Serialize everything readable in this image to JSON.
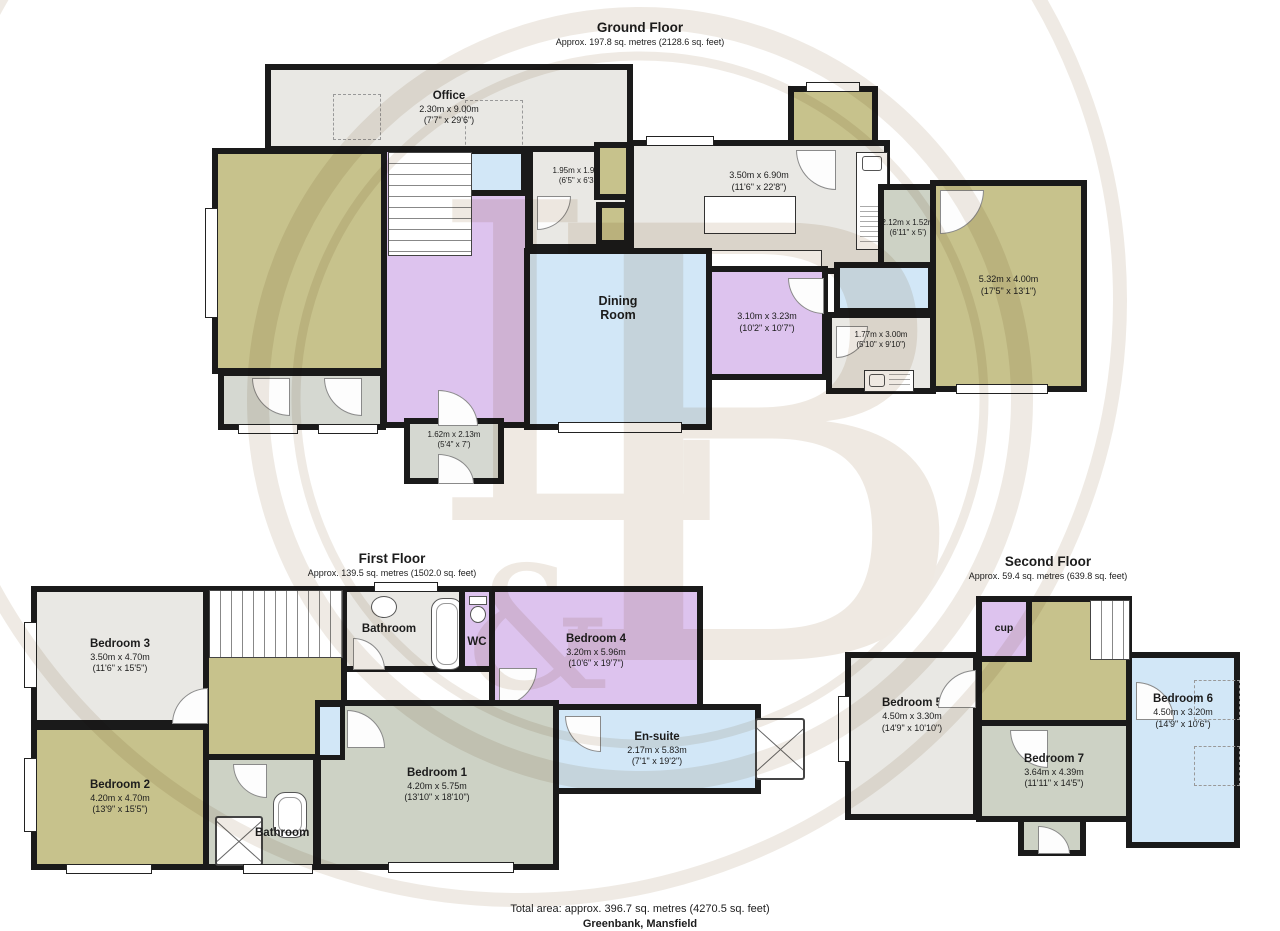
{
  "palette": {
    "wall": "#1a1a1a",
    "olive": "#c7c28c",
    "light_gray_room": "#e9e8e4",
    "green_gray_room": "#cdd2c5",
    "lavender_room": "#ddc3ee",
    "blue_room": "#d2e7f7",
    "conservatory_gray": "#d5d8d1",
    "watermark": "#e9e3da"
  },
  "floors": {
    "ground": {
      "title": "Ground Floor",
      "subtitle": "Approx. 197.8 sq. metres (2128.6 sq. feet)",
      "rooms": {
        "office": {
          "name": "Office",
          "dims_m": "2.30m x 9.00m",
          "dims_ft": "(7'7\" x 29'6\")"
        },
        "hall_small": {
          "dims_m": "1.95m x 1.91m",
          "dims_ft": "(6'5\" x 6'3\")"
        },
        "kitchen": {
          "dims_m": "3.50m x 6.90m",
          "dims_ft": "(11'6\" x 22'8\")"
        },
        "pantry": {
          "dims_m": "2.12m x 1.52m",
          "dims_ft": "(6'11\" x 5')"
        },
        "garage": {
          "dims_m": "5.32m x 4.00m",
          "dims_ft": "(17'5\" x 13'1\")"
        },
        "dining": {
          "name": "Dining Room"
        },
        "family": {
          "dims_m": "3.10m x 3.23m",
          "dims_ft": "(10'2\" x 10'7\")"
        },
        "utility": {
          "dims_m": "1.77m x 3.00m",
          "dims_ft": "(5'10\" x 9'10\")"
        },
        "porch": {
          "dims_m": "1.62m x 2.13m",
          "dims_ft": "(5'4\" x 7')"
        }
      }
    },
    "first": {
      "title": "First Floor",
      "subtitle": "Approx. 139.5 sq. metres (1502.0 sq. feet)",
      "rooms": {
        "bedroom3": {
          "name": "Bedroom 3",
          "dims_m": "3.50m x 4.70m",
          "dims_ft": "(11'6\" x 15'5\")"
        },
        "bedroom2": {
          "name": "Bedroom 2",
          "dims_m": "4.20m x 4.70m",
          "dims_ft": "(13'9\" x 15'5\")"
        },
        "bathroom_top": {
          "name": "Bathroom"
        },
        "wc": {
          "name": "WC"
        },
        "bedroom4": {
          "name": "Bedroom 4",
          "dims_m": "3.20m x 5.96m",
          "dims_ft": "(10'6\" x 19'7\")"
        },
        "ensuite": {
          "name": "En-suite",
          "dims_m": "2.17m x 5.83m",
          "dims_ft": "(7'1\" x 19'2\")"
        },
        "bedroom1": {
          "name": "Bedroom 1",
          "dims_m": "4.20m x 5.75m",
          "dims_ft": "(13'10\" x 18'10\")"
        },
        "bathroom_bottom": {
          "name": "Bathroom"
        }
      }
    },
    "second": {
      "title": "Second Floor",
      "subtitle": "Approx. 59.4 sq. metres (639.8 sq. feet)",
      "rooms": {
        "cup": {
          "name": "cup"
        },
        "bedroom5": {
          "name": "Bedroom 5",
          "dims_m": "4.50m x 3.30m",
          "dims_ft": "(14'9\" x 10'10\")"
        },
        "bedroom6": {
          "name": "Bedroom 6",
          "dims_m": "4.50m x 3.20m",
          "dims_ft": "(14'9\" x 10'6\")"
        },
        "bedroom7": {
          "name": "Bedroom 7",
          "dims_m": "3.64m x 4.39m",
          "dims_ft": "(11'11\" x 14'5\")"
        }
      }
    }
  },
  "footer": {
    "total": "Total area: approx. 396.7 sq. metres (4270.5 sq. feet)",
    "address": "Greenbank, Mansfield"
  },
  "watermark": {
    "l1": "L",
    "amp": "&",
    "l2": "B"
  }
}
